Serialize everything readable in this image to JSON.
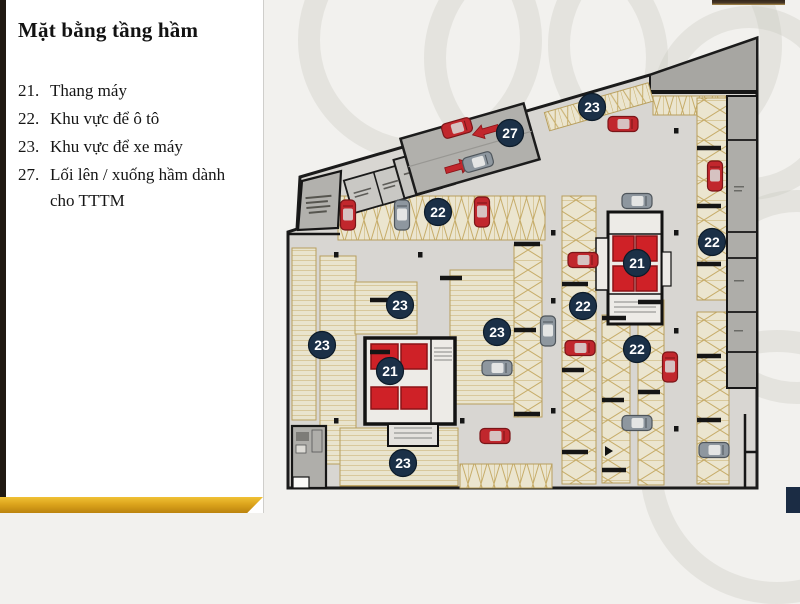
{
  "slide": {
    "title": "Mặt bằng tầng hầm",
    "legend": {
      "items": [
        {
          "num": "21.",
          "label": "Thang máy"
        },
        {
          "num": "22.",
          "label": "Khu vực để ô tô"
        },
        {
          "num": "23.",
          "label": "Khu vực để xe máy"
        },
        {
          "num": "27.",
          "label": "Lối lên / xuống hầm dành cho TTTM"
        }
      ]
    }
  },
  "floorplan": {
    "marker_color": "#1b3047",
    "marker_ring_color": "#0d1b29",
    "marker_text_color": "#ffffff",
    "markers": [
      {
        "label": "27",
        "x": 510,
        "y": 133
      },
      {
        "label": "23",
        "x": 592,
        "y": 107
      },
      {
        "label": "22",
        "x": 438,
        "y": 212
      },
      {
        "label": "22",
        "x": 712,
        "y": 242
      },
      {
        "label": "21",
        "x": 637,
        "y": 263
      },
      {
        "label": "22",
        "x": 583,
        "y": 306
      },
      {
        "label": "23",
        "x": 400,
        "y": 305
      },
      {
        "label": "23",
        "x": 497,
        "y": 332
      },
      {
        "label": "23",
        "x": 322,
        "y": 345
      },
      {
        "label": "21",
        "x": 390,
        "y": 371
      },
      {
        "label": "22",
        "x": 637,
        "y": 349
      },
      {
        "label": "23",
        "x": 403,
        "y": 463
      }
    ]
  },
  "colors": {
    "accent_gold": "#dca41c",
    "sidebar_bar": "#201912",
    "navy_corner": "#1b2c44",
    "car_red": "#c1272d",
    "car_gray": "#8e979f",
    "floor": "#d8d6d2",
    "stall_line": "#c7ad6a"
  }
}
